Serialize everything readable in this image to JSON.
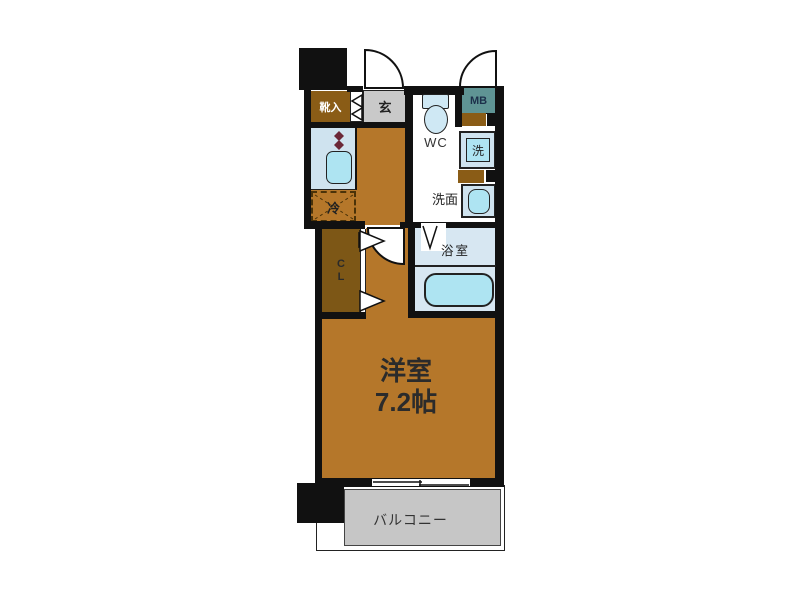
{
  "floorplan": {
    "labels": {
      "main_room_name": "洋室",
      "main_room_size": "7.2帖",
      "balcony": "バルコニー",
      "entrance": "玄",
      "shoe_cabinet": "靴入",
      "toilet": "WC",
      "washroom": "洗面",
      "bathroom": "浴室",
      "meter_box": "MB",
      "washing_machine": "洗",
      "refrigerator": "冷",
      "closet": [
        "C",
        "L"
      ]
    },
    "colors": {
      "main_room": "#b5772a",
      "dark_brown_storage": "#8a5c16",
      "closet_brown": "#7d5716",
      "entrance_gray": "#c9c9c9",
      "counter_blue": "#cfe3ef",
      "fixture_cyan": "#aee4f2",
      "bathroom_blue": "#d7e7f2",
      "meter_box_teal": "#5f9494",
      "balcony_gray": "#c6c6c6",
      "wall_black": "#111111",
      "burner_maroon": "#6b2737"
    }
  }
}
